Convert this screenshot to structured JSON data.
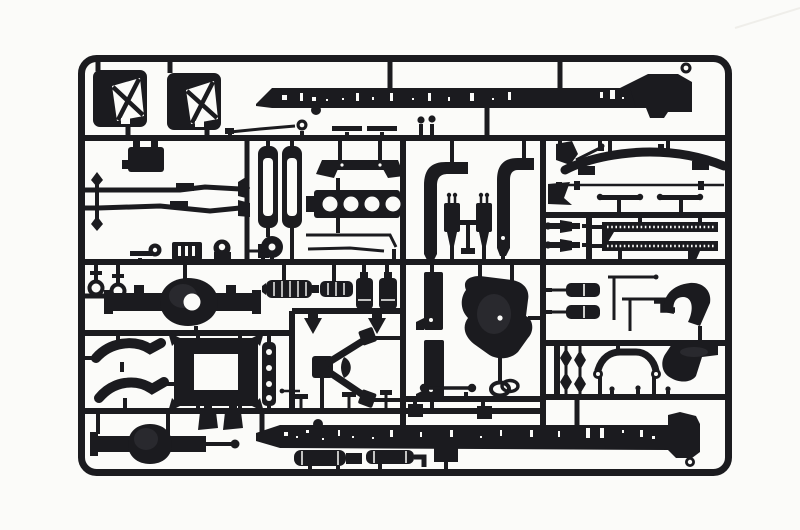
{
  "scene": {
    "type": "photograph",
    "subject": "plastic model kit sprue",
    "description": "Black injection-moulded sprue (runner frame) holding truck chassis model parts, photographed on a plain white background",
    "alt": "Black plastic model kit sprue with truck chassis parts on a white background"
  },
  "colors": {
    "bg": "#fbfbf9",
    "plastic": "#1b1b1f",
    "sheen": "#34343a",
    "artifact": "#efeeea"
  },
  "parts": [
    "cab corner panel (left)",
    "cab corner panel (right)",
    "chassis rail (top)",
    "chassis rail (bottom)",
    "gear lever rod",
    "engine mount bracket",
    "steering link (upper)",
    "steering link (lower)",
    "radiator frames",
    "fan pulley disc",
    "cab step bracket",
    "engine block",
    "exhaust stack (left)",
    "exhaust stack (right)",
    "shock absorbers",
    "gear stick stand",
    "front axle beam",
    "track rod",
    "steering T-bars",
    "drag link ends",
    "perforated step strips",
    "tow rings",
    "rear axle housing",
    "mufflers",
    "air canisters",
    "tall chassis brackets",
    "transmission housing",
    "air tanks",
    "L-shaped rods",
    "elbow pipe",
    "mudguard (front)",
    "mudguard (rear)",
    "spring links",
    "anti-roll bar",
    "V-stay torque rod",
    "retaining clips",
    "leaf spring brackets",
    "battery box frame",
    "ladder strip",
    "front axle housing",
    "drive shaft",
    "mounting blocks",
    "fuel tanks"
  ]
}
